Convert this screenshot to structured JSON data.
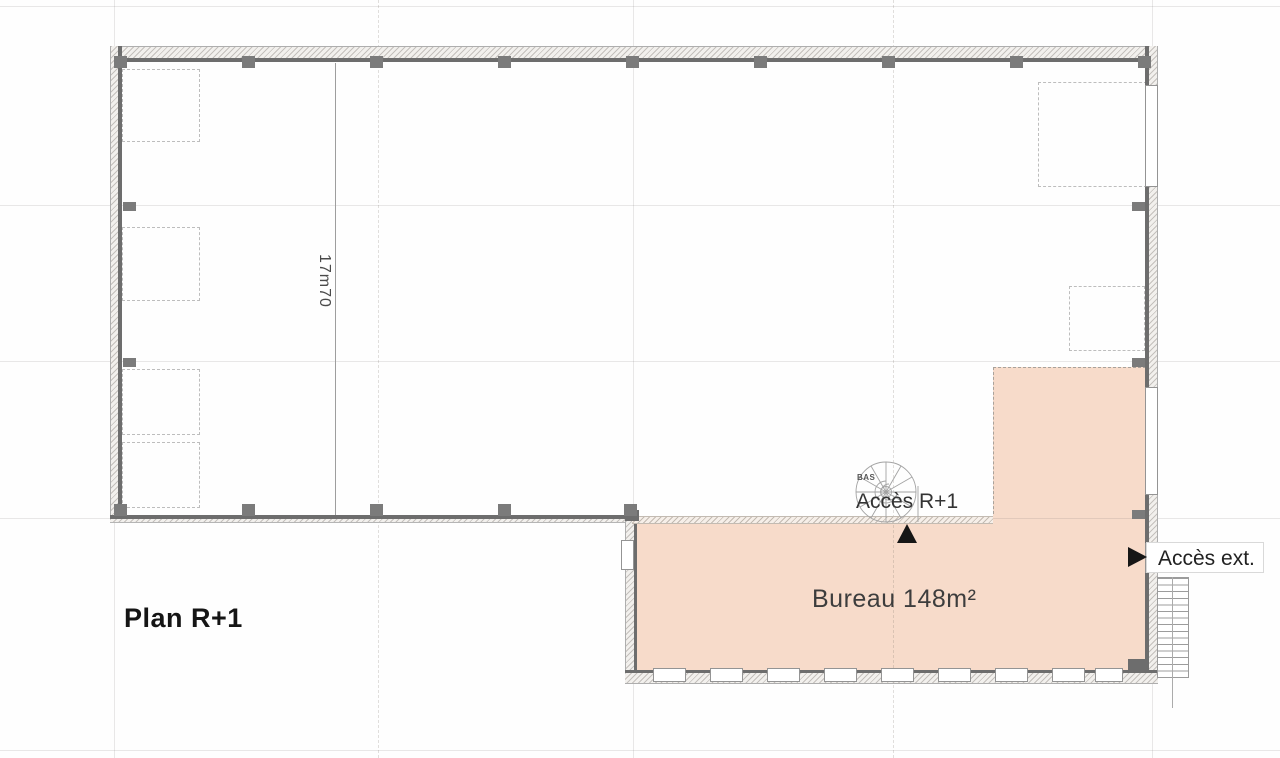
{
  "drawing": {
    "title": "Plan R+1",
    "room": {
      "label": "Bureau 148m²",
      "name": "Bureau",
      "area": "148m²"
    },
    "annotations": {
      "access_r1": "Accès R+1",
      "access_ext": "Accès ext.",
      "stair_direction": "BAS",
      "dimension_height": "17m70"
    }
  },
  "colors": {
    "room_fill": "#f7dbca",
    "wall_dark": "#6d6d6d",
    "wall_fill": "#f2f0ed",
    "grid_line": "#e9e9e9",
    "arrow_black": "#161616",
    "text_dark": "#151515"
  }
}
